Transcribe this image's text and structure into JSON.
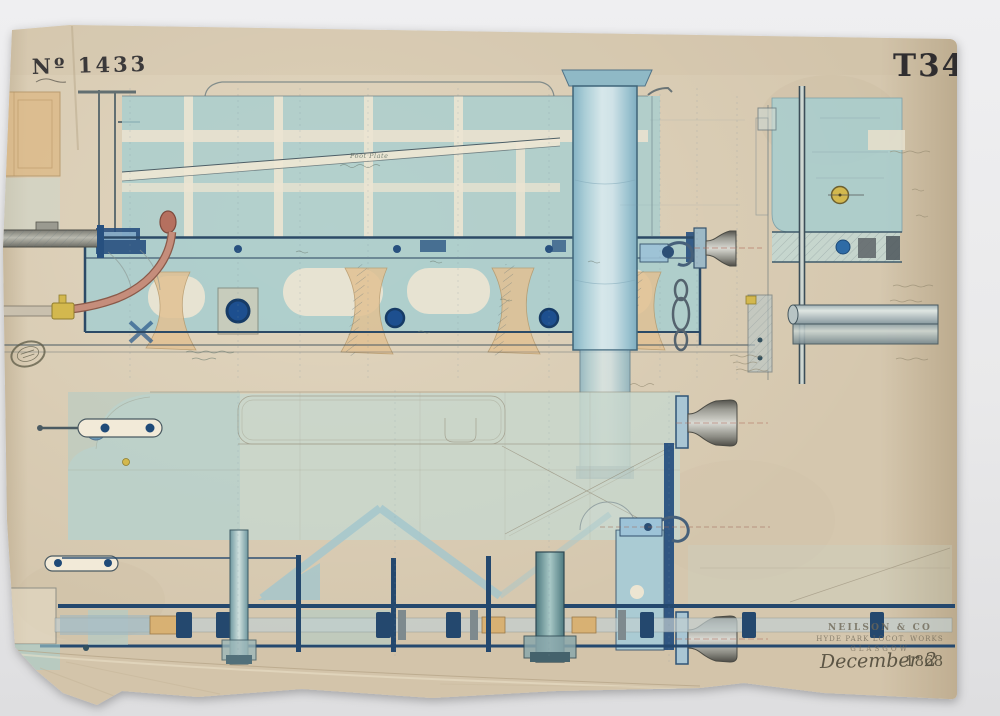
{
  "sheet": {
    "drawing_number": "Nº 1433",
    "catalog_code": "T349",
    "annotations": {
      "foot_plate": "Foot Plate"
    },
    "maker_stamp": {
      "company": "NEILSON & CO",
      "works": "HYDE PARK LOCOT. WORKS",
      "city": "GLASGOW",
      "date_month_day": "December 2",
      "date_year": "1868"
    },
    "colors": {
      "background": "#e9e9eb",
      "paper": "#d5c7ae",
      "paper_dark": "#c4b294",
      "wash_teal": "#a7cecf",
      "wash_plan": "#c8d7cd",
      "ink_blue": "#27507f",
      "ink_dark": "#3d5060",
      "spring_tan": "#e2c193",
      "copper": "#c58d7b",
      "brass": "#d3b84e",
      "metal": "#8e8e86",
      "stamp_ink": "#6e6757",
      "black_ink": "#26252a"
    }
  }
}
